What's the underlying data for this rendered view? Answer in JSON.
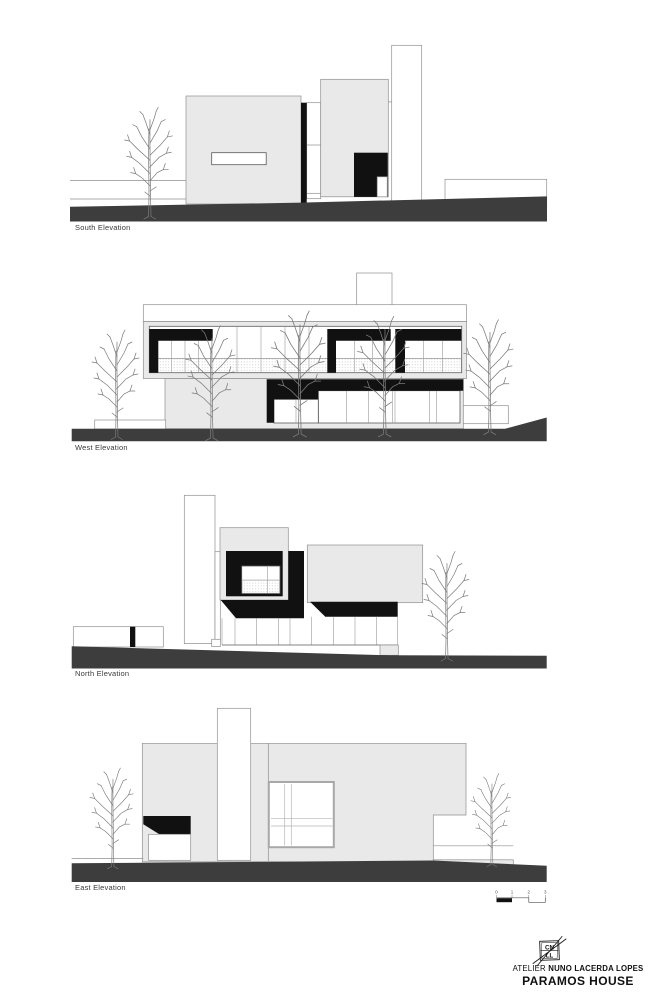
{
  "document": {
    "project_title": "PARAMOS HOUSE",
    "studio_prefix": "ATELIER",
    "studio_name": "NUNO LACERDA LOPES",
    "logo_top": "CN",
    "logo_bottom": "LL"
  },
  "elevations": [
    {
      "id": "south",
      "label": "South Elevation"
    },
    {
      "id": "west",
      "label": "West Elevation"
    },
    {
      "id": "north",
      "label": "North Elevation"
    },
    {
      "id": "east",
      "label": "East Elevation"
    }
  ],
  "scalebar": {
    "marks": [
      "0",
      "1",
      "2",
      "3"
    ]
  },
  "colors": {
    "background": "#ffffff",
    "fill_light": "#e9e9e9",
    "fill_black": "#111111",
    "ground": "#3d3d3d",
    "outline": "#8f8f8f",
    "outline_dark": "#5a5a5a",
    "text": "#3a3a3a"
  }
}
